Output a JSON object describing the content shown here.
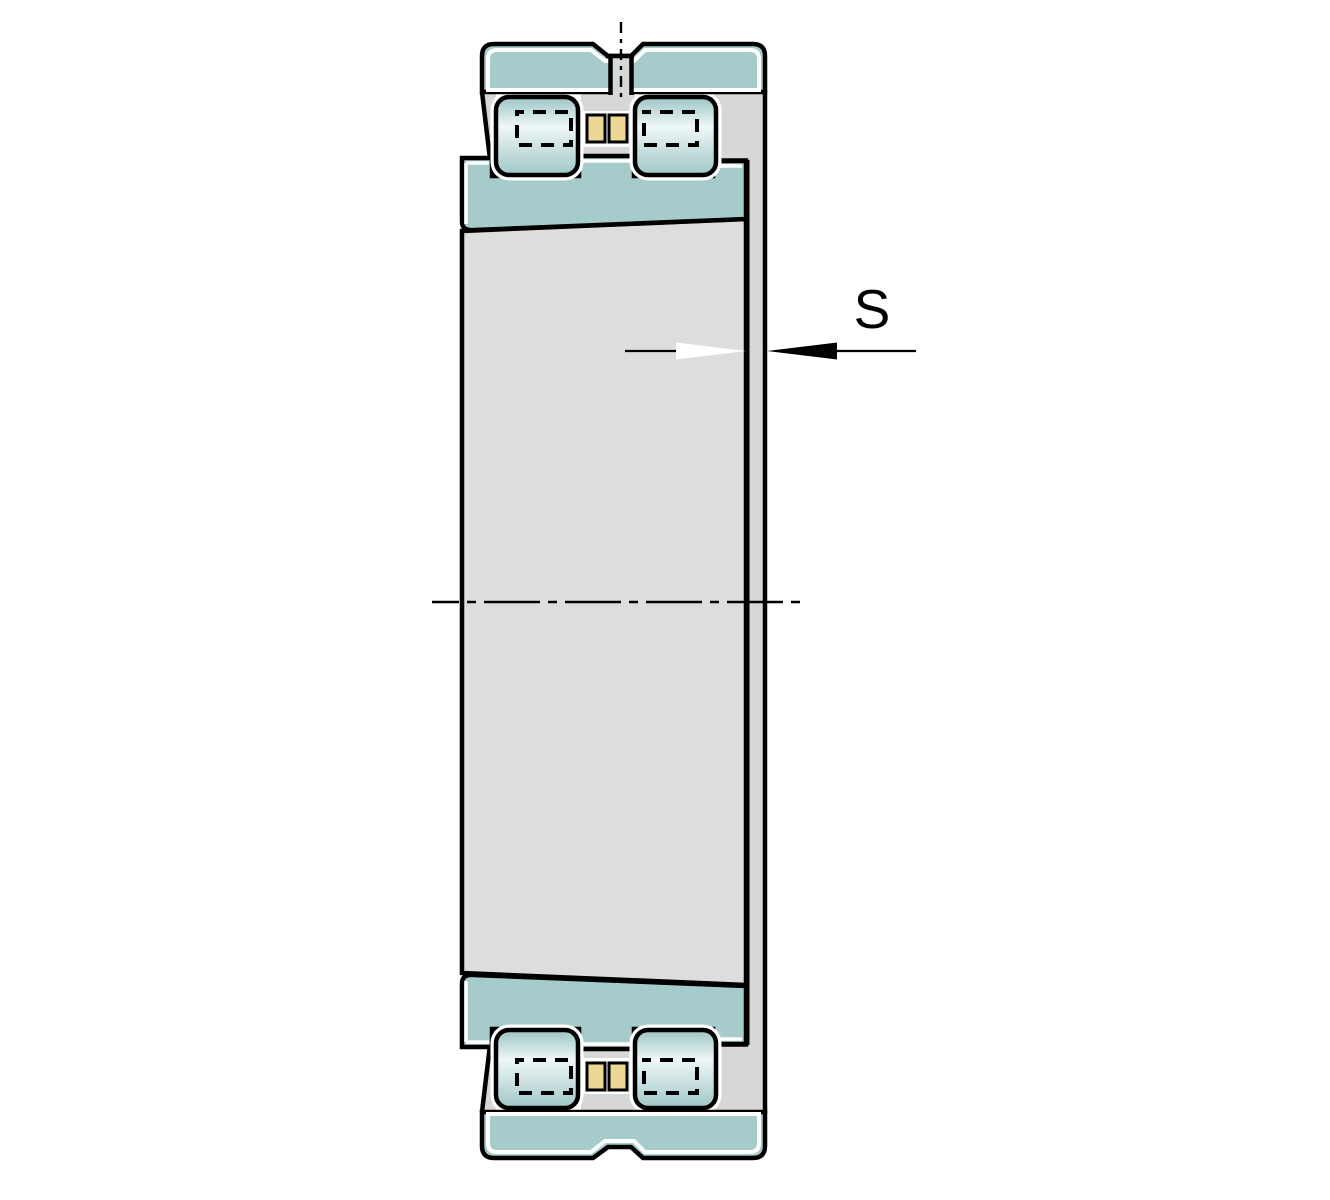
{
  "diagram": {
    "name": "double-row-cylindrical-roller-bearing-cross-section",
    "dimension": {
      "label": "S"
    },
    "parts": [
      "outer-ring-top",
      "outer-ring-bottom",
      "roller-top-left",
      "roller-top-right",
      "roller-bottom-left",
      "roller-bottom-right",
      "cage-bar-top-left",
      "cage-bar-top-right",
      "cage-bar-bottom-left",
      "cage-bar-bottom-right",
      "inner-ring-top",
      "inner-ring-bottom",
      "tapered-sleeve",
      "side-wall",
      "lubrication-hole-centerline",
      "bearing-axis-centerline",
      "s-dimension"
    ]
  },
  "colors": {
    "page_white": "#ffffff",
    "ring_teal": "#a5cbcb",
    "roller_edge_top": "#9cc3c3",
    "roller_mid": "#eff7f7",
    "roller_edge_bottom": "#a0c7c7",
    "cage_yellow": "#ecd795",
    "sleeve_gray": "#dcdddd",
    "wall_gray": "#d6d8d8",
    "line_black": "#000000",
    "highlight_white": "#ffffff"
  }
}
